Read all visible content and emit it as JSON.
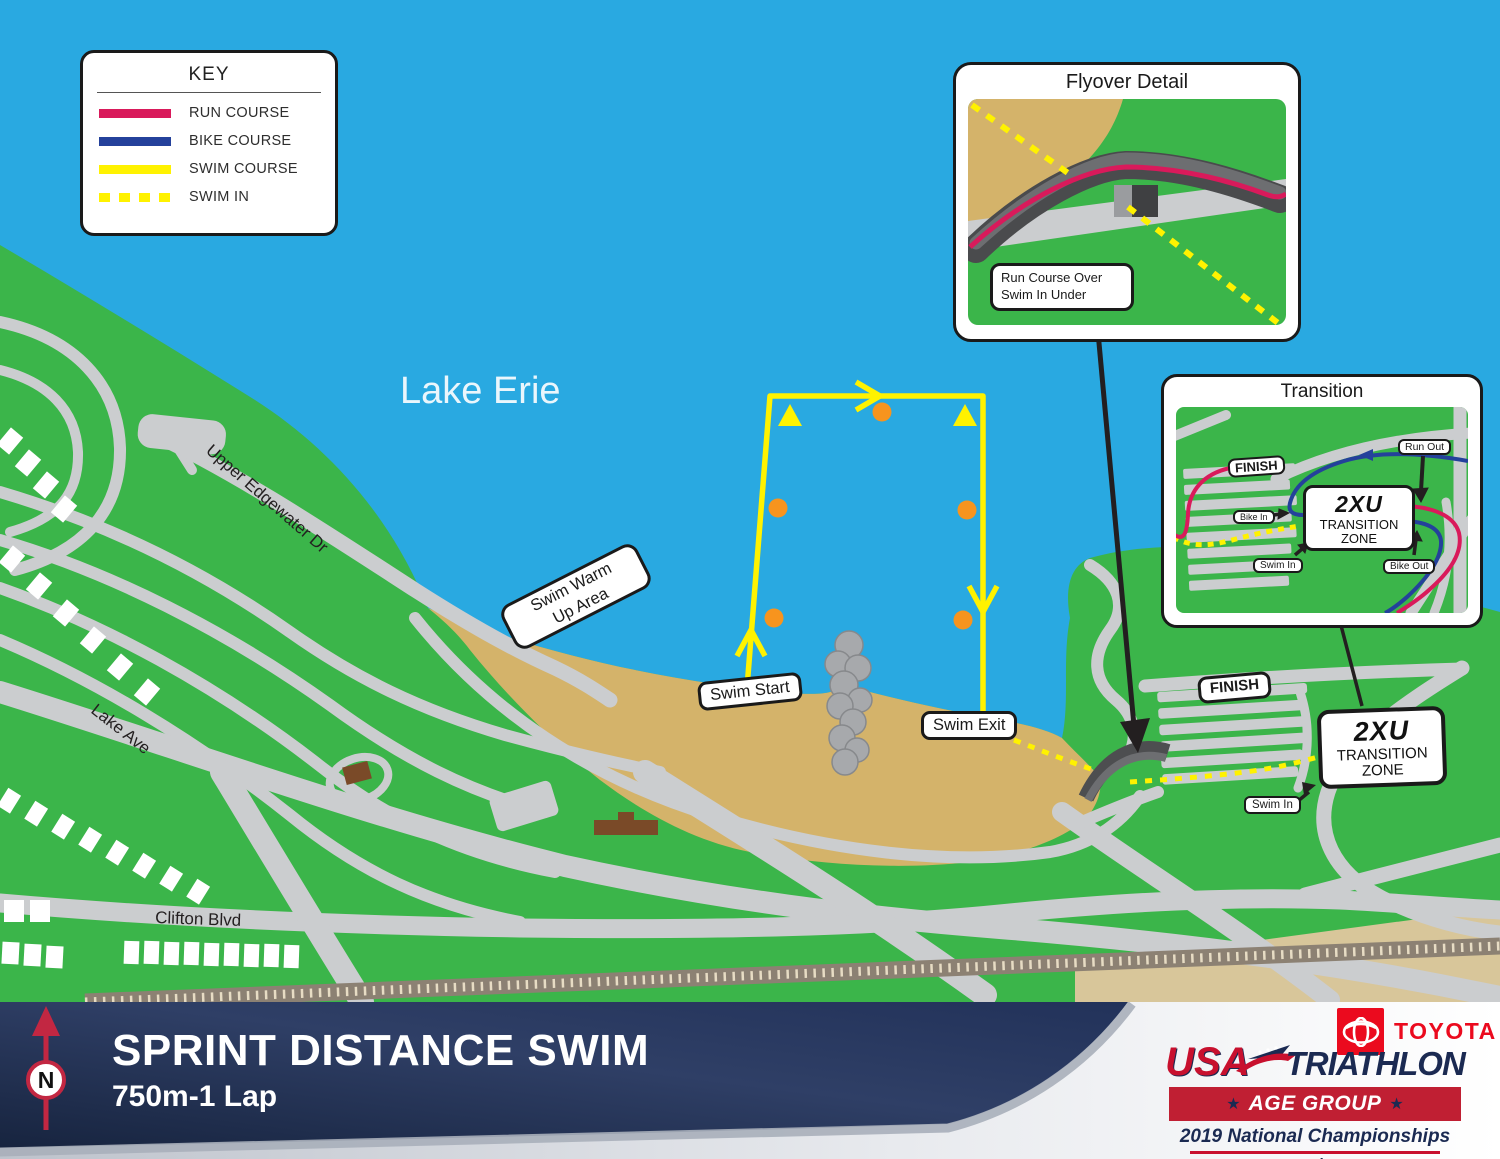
{
  "key": {
    "title": "KEY",
    "items": [
      {
        "label": "RUN COURSE",
        "color": "#D91A5B",
        "style": "solid"
      },
      {
        "label": "BIKE COURSE",
        "color": "#24419B",
        "style": "solid"
      },
      {
        "label": "SWIM COURSE",
        "color": "#FFF200",
        "style": "solid"
      },
      {
        "label": "SWIM IN",
        "color": "#FFF200",
        "style": "dashed"
      }
    ]
  },
  "map": {
    "lake_label": "Lake Erie",
    "roads": {
      "upper_edgewater": "Upper Edgewater Dr",
      "lake_ave": "Lake Ave",
      "clifton_blvd": "Clifton Blvd"
    },
    "labels": {
      "swim_warm_up_line1": "Swim Warm",
      "swim_warm_up_line2": "Up Area",
      "swim_start": "Swim Start",
      "swim_exit": "Swim Exit",
      "finish": "FINISH",
      "swim_in": "Swim In",
      "zone_brand": "2XU",
      "zone_line1": "TRANSITION",
      "zone_line2": "ZONE"
    }
  },
  "flyover_inset": {
    "title": "Flyover Detail",
    "note_line1": "Run Course Over",
    "note_line2": "Swim In Under"
  },
  "transition_inset": {
    "title": "Transition",
    "labels": {
      "finish": "FINISH",
      "run_out": "Run Out",
      "bike_in": "Bike In",
      "swim_in": "Swim In",
      "bike_out": "Bike Out",
      "zone_brand": "2XU",
      "zone_line1": "TRANSITION",
      "zone_line2": "ZONE"
    }
  },
  "footer": {
    "title": "SPRINT DISTANCE SWIM",
    "subtitle": "750m-1 Lap",
    "compass_letter": "N",
    "toyota": "TOYOTA",
    "usa": "USA",
    "triathlon": "TRIATHLON",
    "age_group": "AGE GROUP",
    "star": "★",
    "championships": "2019 National Championships",
    "series": "Sprint"
  },
  "colors": {
    "water": "#29A9E1",
    "land": "#3BB54A",
    "sand": "#D4B36A",
    "road": "#CBCDCF",
    "run_course": "#D91A5B",
    "bike_course": "#24419B",
    "swim_course": "#FFF200",
    "buoy_orange": "#F7941E",
    "footer_navy": "#1A2947",
    "brand_red": "#C8102E",
    "brand_navy": "#1B2A52"
  }
}
